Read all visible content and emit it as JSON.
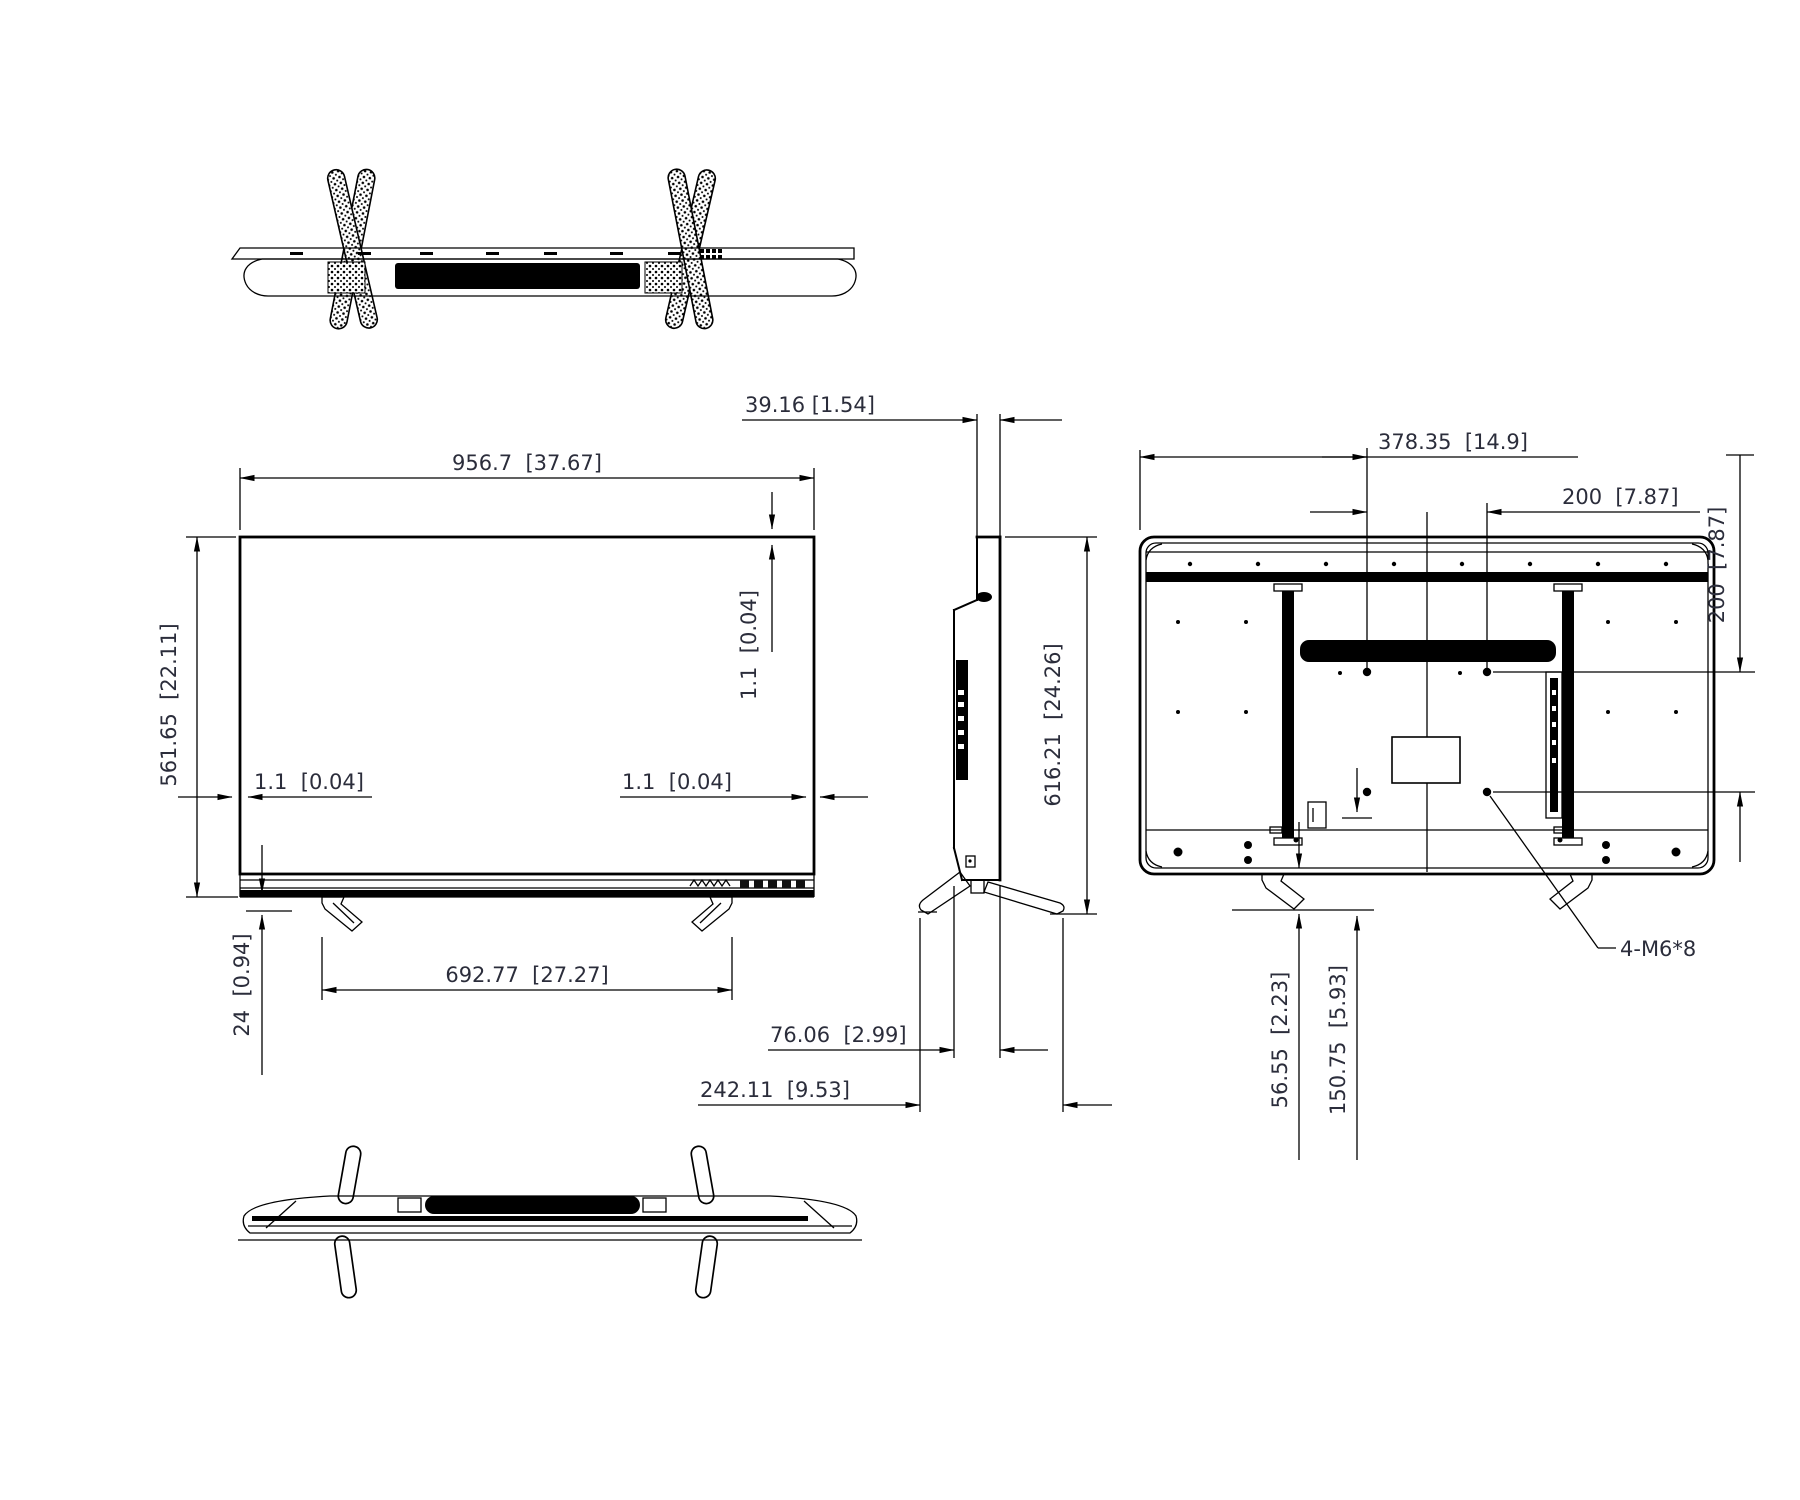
{
  "dimensions": {
    "front_width": "956.7  [37.67]",
    "front_height": "561.65  [22.11]",
    "bezel_top": "1.1  [0.04]",
    "bezel_left": "1.1  [0.04]",
    "bezel_right": "1.1  [0.04]",
    "panel_thickness": "39.16 [1.54]",
    "feet_span": "692.77  [27.27]",
    "feet_height": "24  [0.94]",
    "total_height": "616.21  [24.26]",
    "body_depth": "76.06  [2.99]",
    "stand_depth": "242.11  [9.53]",
    "vesa_offset": "378.35  [14.9]",
    "vesa_width": "200  [7.87]",
    "vesa_height": "200  [7.87]",
    "screw_spec": "4-M6*8",
    "stand_height": "56.55  [2.23]",
    "stand_clearance": "150.75  [5.93]"
  },
  "colors": {
    "line": "#000000",
    "text": "#2b2d3b",
    "background": "#ffffff"
  }
}
